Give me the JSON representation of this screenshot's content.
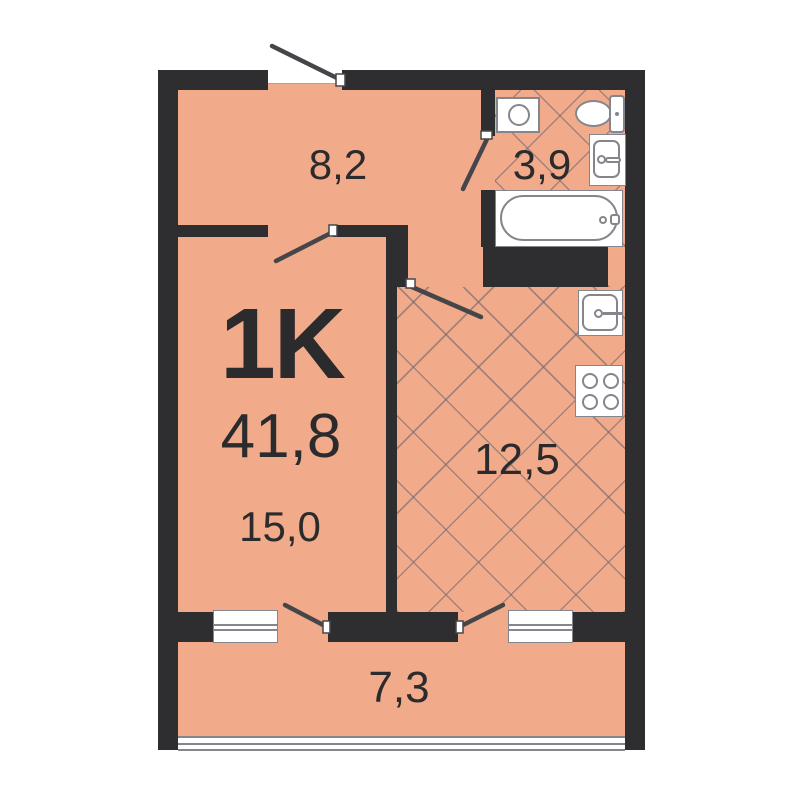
{
  "plan": {
    "title": "apartment-floor-plan",
    "labels": {
      "type": "1K",
      "total": "41,8",
      "hallway": "8,2",
      "bathroom": "3,9",
      "living": "15,0",
      "kitchen": "12,5",
      "balcony": "7,3"
    },
    "rooms": [
      {
        "id": "hallway",
        "area": "8,2"
      },
      {
        "id": "bathroom",
        "area": "3,9",
        "floor": "tiled-hatch"
      },
      {
        "id": "living-room",
        "area": "15,0"
      },
      {
        "id": "kitchen",
        "area": "12,5",
        "floor": "tiled-hatch"
      },
      {
        "id": "balcony",
        "area": "7,3"
      }
    ],
    "fixtures": [
      "washing-machine",
      "toilet",
      "bathroom-sink",
      "bathtub",
      "kitchen-sink",
      "stove",
      "window",
      "window",
      "balcony-glazing"
    ],
    "doors": [
      "entrance-door",
      "living-room-door",
      "bathroom-door",
      "kitchen-door",
      "living-balcony-door",
      "kitchen-balcony-door"
    ],
    "colors": {
      "wall": "#2e2e30",
      "floor": "#f2ab8a",
      "fixture_stroke": "#85858d",
      "door_swing": "#46464a",
      "text": "#2b2b2d",
      "background": "#ffffff"
    }
  }
}
